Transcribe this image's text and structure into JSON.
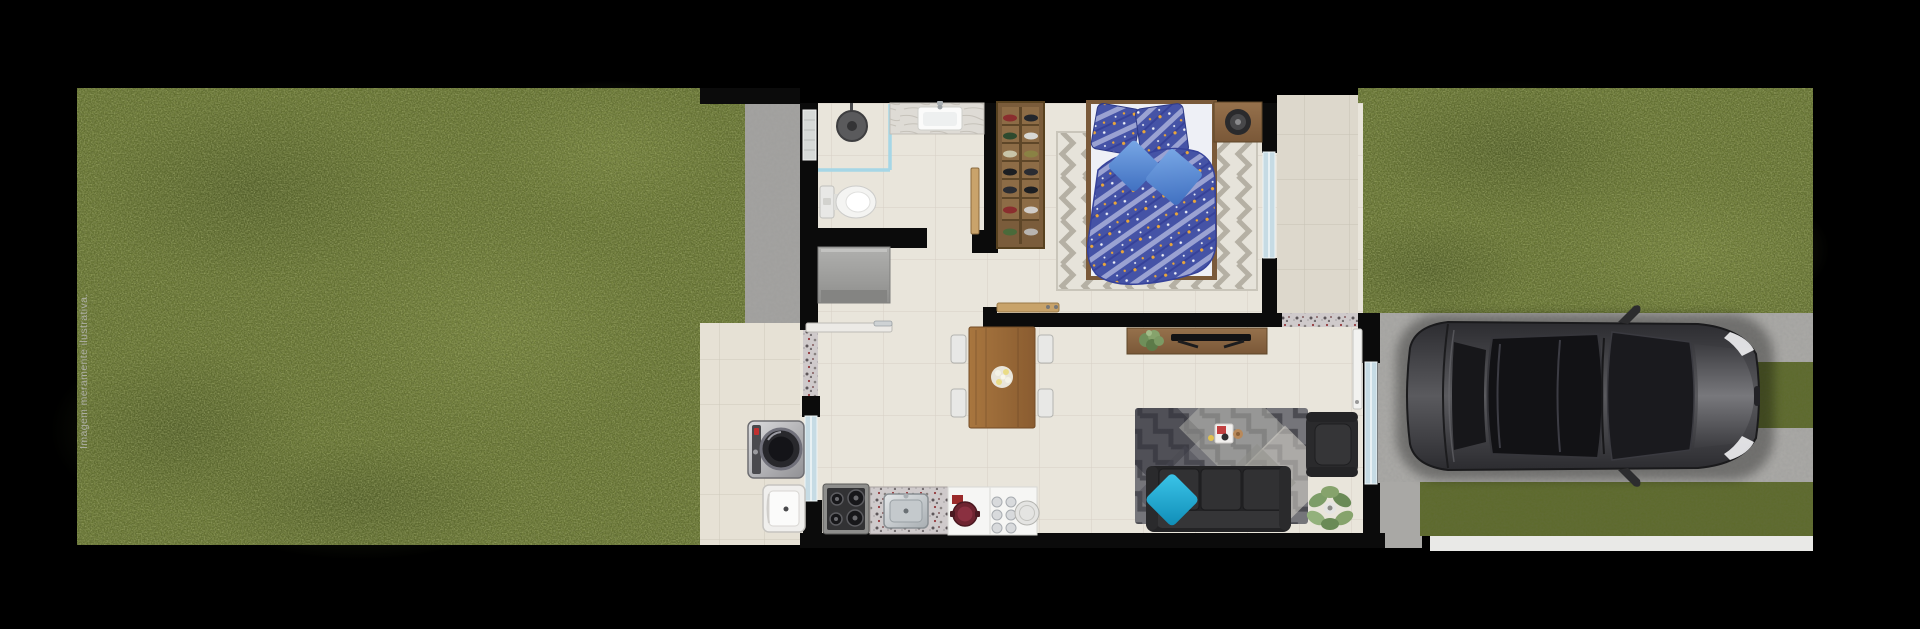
{
  "disclaimer": "Imagem meramente ilustrativa.",
  "palette": {
    "background": "#000000",
    "grass": "#64722f",
    "grass_dark": "#46521d",
    "walkway_concrete": "#a3a2a0",
    "driveway_concrete": "#a9a8a5",
    "interior_tile": "#e9e5db",
    "patio_tile": "#e6e1d5",
    "entry_tile": "#ddd8cc",
    "wall_black": "#0b0b0b",
    "window_glass": "#c6dbe4",
    "shower_glass": "#a6d6e6",
    "wood": "#8a6745",
    "dining_wood": "#9c6e3f",
    "closet_wood": "#7a5c3b",
    "duvet_blue": "#4553a6",
    "cushion_blue": "#5b8fd8",
    "sofa_charcoal": "#2a2a2c",
    "pillow_cyan": "#1fa9d6",
    "car_body": "#4a4a4e",
    "sidewalk_strip": "#e9e9e7",
    "granite": "#cfcacb"
  },
  "scene": {
    "outdoor": [
      "left-lawn",
      "side-walkway",
      "service-patio",
      "entry-walkway",
      "right-lawn",
      "driveway",
      "driveway-grass-island",
      "street-lawn-strip",
      "sidewalk-strip",
      "car"
    ],
    "bathroom": [
      "shower-head",
      "shower-glass-partition",
      "toilet",
      "vanity-counter",
      "vanity-sink",
      "bathroom-window",
      "bathroom-door"
    ],
    "bedroom": [
      "shoe-closet",
      "closet-planter",
      "bed",
      "patterned-pillows",
      "blue-cushions",
      "herringbone-rug",
      "nightstand",
      "round-speaker",
      "bedroom-window",
      "wall-shelf"
    ],
    "hall": [
      "gray-dresser"
    ],
    "kitchen_dining": [
      "dining-table",
      "dining-chairs",
      "flower-centerpiece",
      "cooktop",
      "granite-counter",
      "kitchen-sink",
      "white-counter",
      "red-pot",
      "plates",
      "service-door",
      "kitchen-window",
      "service-threshold"
    ],
    "service_area": [
      "washing-machine",
      "laundry-tub"
    ],
    "living_room": [
      "tv-console",
      "tv",
      "console-plant",
      "patchwork-rug",
      "serving-tray",
      "sofa",
      "cyan-pillow",
      "armchair",
      "floor-plant",
      "front-door",
      "front-door-threshold",
      "living-window"
    ]
  }
}
